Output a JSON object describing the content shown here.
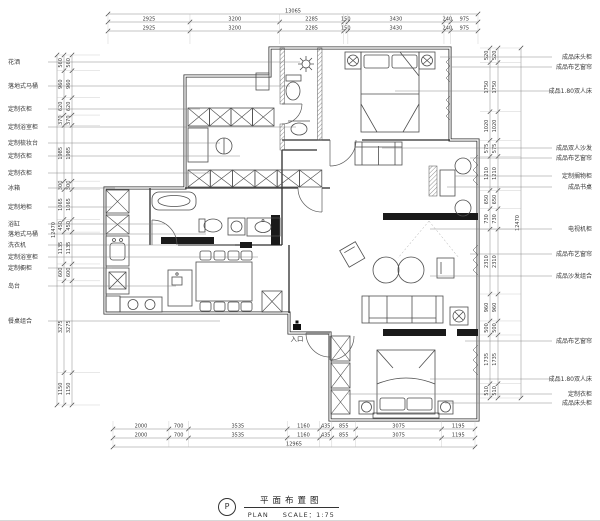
{
  "title_block": {
    "symbol": "P",
    "title_cn": "平面布置图",
    "title_en": "PLAN",
    "scale_text": "SCALE：1:75"
  },
  "entry_label": "入口",
  "colors": {
    "wall": "#2d2d2d",
    "furniture": "#4e4e4e",
    "dim_line": "#8a8a8a",
    "dim_text": "#3a3a3a",
    "black_fill": "#1a1a1a"
  },
  "dims": {
    "top": {
      "total": "13065",
      "segments": [
        2925,
        3200,
        2285,
        150,
        3430,
        240,
        975
      ]
    },
    "bottom": {
      "total": "12965",
      "segments": [
        2000,
        700,
        3535,
        1160,
        435,
        855,
        3075,
        1195
      ]
    },
    "left": {
      "total": "12470",
      "segments": [
        560,
        960,
        620,
        370,
        1985,
        300,
        1065,
        450,
        1135,
        600,
        3275,
        1150
      ]
    },
    "right": {
      "total": "12470",
      "segments": [
        520,
        1750,
        1020,
        575,
        1210,
        650,
        730,
        2310,
        960,
        500,
        1735,
        510
      ]
    }
  },
  "annotations": {
    "left": [
      {
        "text": "花洒",
        "y": 62,
        "to": 300
      },
      {
        "text": "落地式马桶",
        "y": 86,
        "to": 290
      },
      {
        "text": "定制衣柜",
        "y": 109,
        "to": 200
      },
      {
        "text": "定制浴室柜",
        "y": 127,
        "to": 296
      },
      {
        "text": "定制梳妆台",
        "y": 143,
        "to": 220
      },
      {
        "text": "定制衣柜",
        "y": 156,
        "to": 240
      },
      {
        "text": "定制衣柜",
        "y": 173,
        "to": 210
      },
      {
        "text": "冰箱",
        "y": 188,
        "to": 115
      },
      {
        "text": "定制地柜",
        "y": 207,
        "to": 112
      },
      {
        "text": "浴缸",
        "y": 224,
        "to": 165
      },
      {
        "text": "落地式马桶",
        "y": 234,
        "to": 206
      },
      {
        "text": "洗衣机",
        "y": 245,
        "to": 235
      },
      {
        "text": "定制浴室柜",
        "y": 257,
        "to": 258
      },
      {
        "text": "定制橱柜",
        "y": 268,
        "to": 112
      },
      {
        "text": "岛台",
        "y": 286,
        "to": 176
      },
      {
        "text": "餐桌组合",
        "y": 321,
        "to": 220
      }
    ],
    "right": [
      {
        "text": "成品床头柜",
        "y": 57,
        "to": 440
      },
      {
        "text": "成品布艺窗帘",
        "y": 67,
        "to": 452
      },
      {
        "text": "成品1.80双人床",
        "y": 91,
        "to": 395
      },
      {
        "text": "成品双人沙发",
        "y": 148,
        "to": 382
      },
      {
        "text": "成品布艺窗帘",
        "y": 158,
        "to": 470
      },
      {
        "text": "定制搁物柜",
        "y": 176,
        "to": 455
      },
      {
        "text": "成品书桌",
        "y": 187,
        "to": 447
      },
      {
        "text": "电视机柜",
        "y": 229,
        "to": 430
      },
      {
        "text": "成品布艺窗帘",
        "y": 254,
        "to": 470
      },
      {
        "text": "成品沙发组合",
        "y": 276,
        "to": 430
      },
      {
        "text": "成品布艺窗帘",
        "y": 341,
        "to": 465
      },
      {
        "text": "成品1.80双人床",
        "y": 379,
        "to": 430
      },
      {
        "text": "定制衣柜",
        "y": 394,
        "to": 348
      },
      {
        "text": "成品床头柜",
        "y": 403,
        "to": 445
      }
    ]
  }
}
